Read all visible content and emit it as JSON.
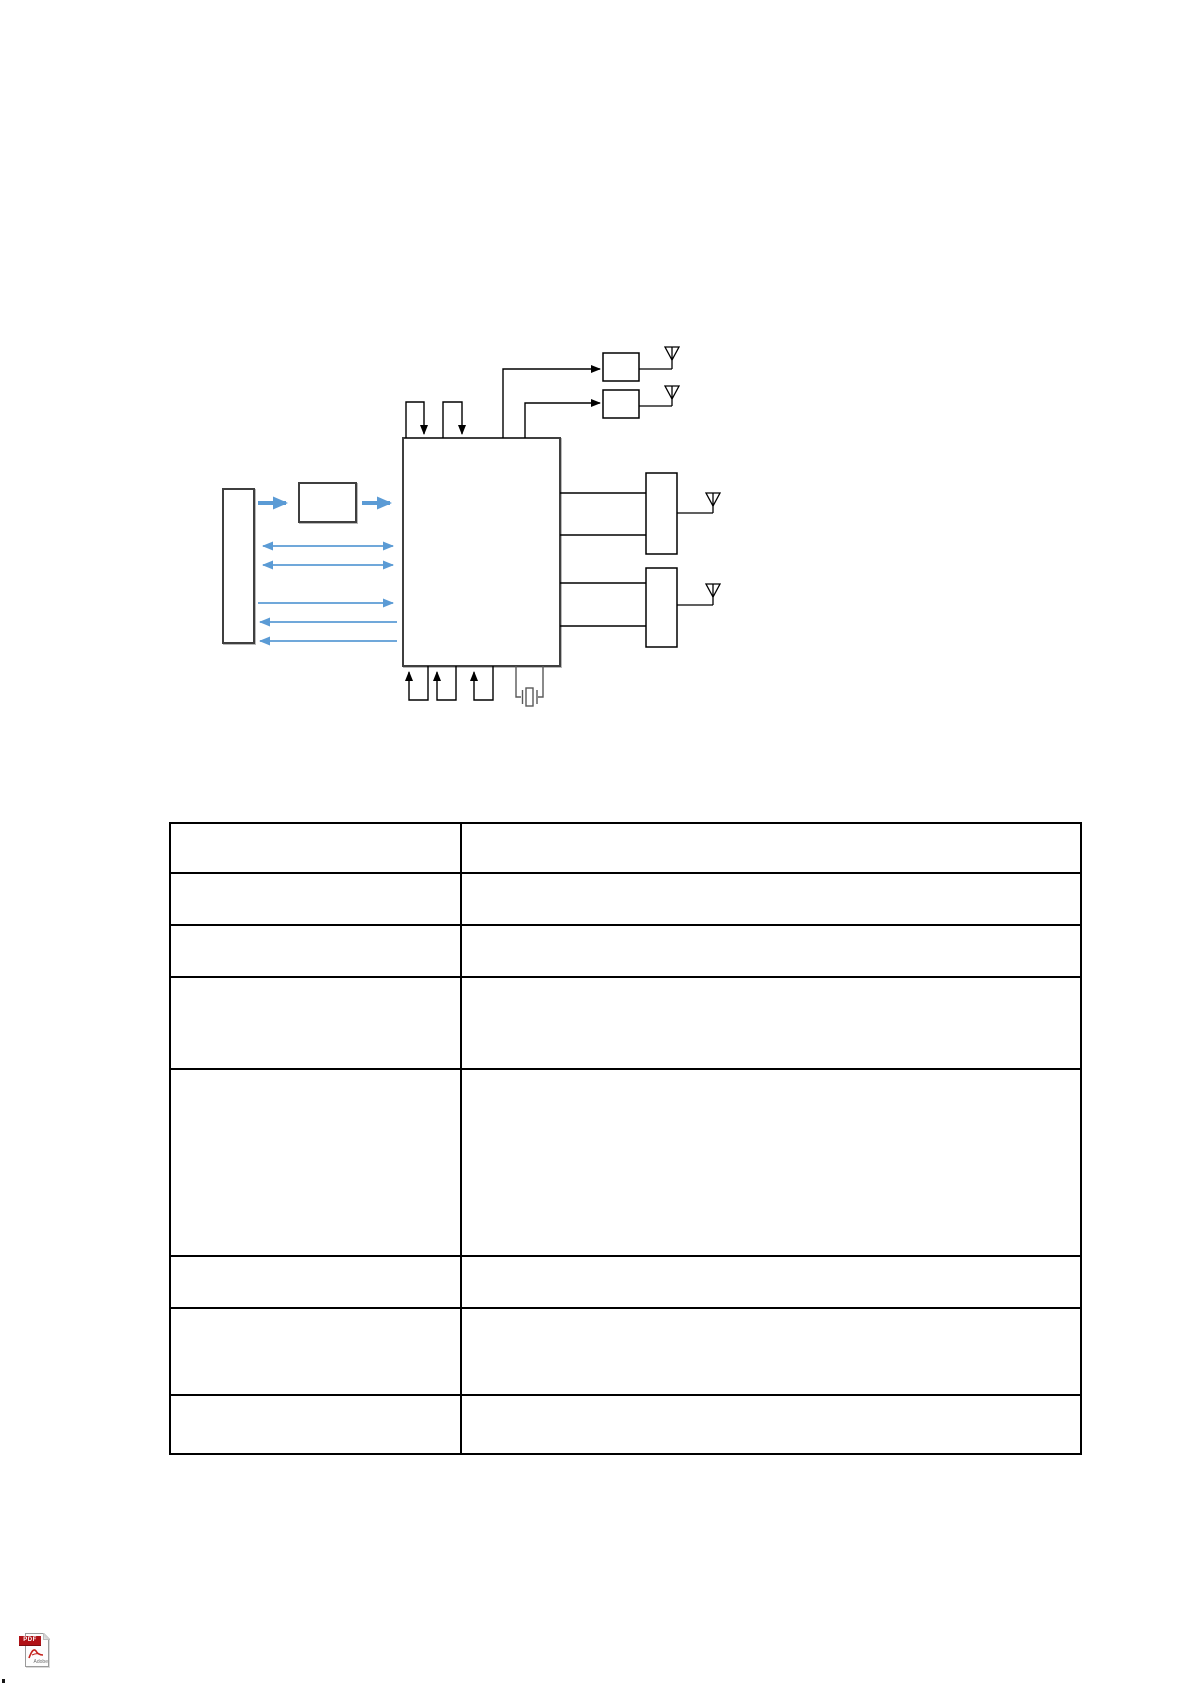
{
  "page": {
    "width": 1192,
    "height": 1685,
    "background": "#ffffff"
  },
  "colors": {
    "accent_blue": "#5B9BD5",
    "diagram_line": "#000000",
    "box_border": "#3f3f3f",
    "crystal_gray": "#595959",
    "table_line": "#000000",
    "pdf_red": "#b01116"
  },
  "diagram": {
    "main_blocks": 3,
    "rf_switch_boxes": 2,
    "right_front_end_boxes": 2,
    "antenna_count": 4,
    "top_pin_loops": 2,
    "bottom_pin_loops": 3,
    "has_crystal": true,
    "blue_links": [
      {
        "style": "thick",
        "direction": "right"
      },
      {
        "style": "thin",
        "direction": "both"
      },
      {
        "style": "thin",
        "direction": "both"
      },
      {
        "style": "thin",
        "direction": "right"
      },
      {
        "style": "thin",
        "direction": "left"
      },
      {
        "style": "thin",
        "direction": "left"
      }
    ]
  },
  "table": {
    "rows": 8,
    "columns": 2,
    "cells": [
      [
        "",
        ""
      ],
      [
        "",
        ""
      ],
      [
        "",
        ""
      ],
      [
        "",
        ""
      ],
      [
        "",
        ""
      ],
      [
        "",
        ""
      ],
      [
        "",
        ""
      ],
      [
        "",
        ""
      ]
    ]
  },
  "pdf_icon": {
    "banner": "PDF",
    "brand": "Adobe"
  }
}
